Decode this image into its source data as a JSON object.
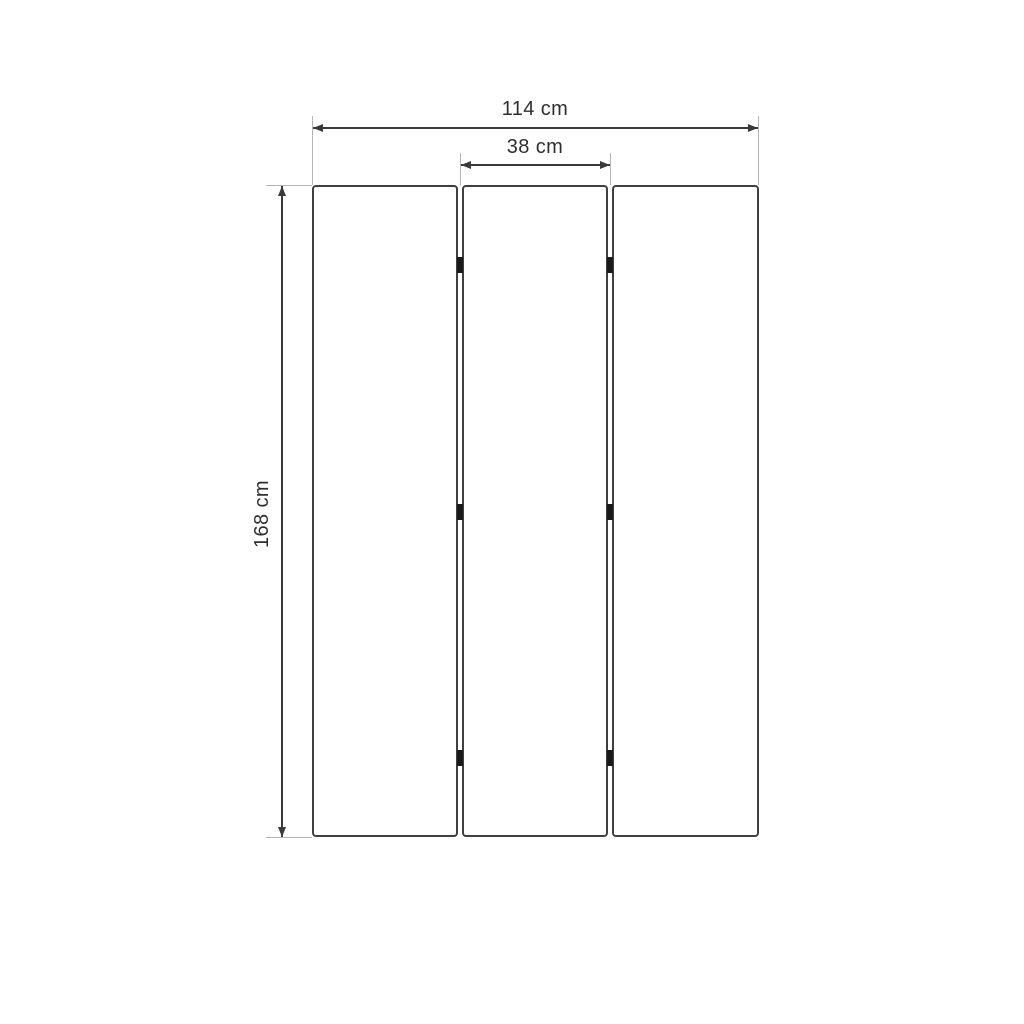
{
  "diagram": {
    "name": "three-panel-folding-screen-dimension-drawing",
    "type": "dimension-drawing",
    "panel_count": 3,
    "dimensions": {
      "total_width": {
        "label": "114 cm",
        "value": 114,
        "unit": "cm"
      },
      "panel_width": {
        "label": "38 cm",
        "value": 38,
        "unit": "cm"
      },
      "height": {
        "label": "168 cm",
        "value": 168,
        "unit": "cm"
      }
    },
    "colors": {
      "background": "#ffffff",
      "panel_border": "#404040",
      "dimension_line": "#3a3a3a",
      "extension_line": "#b5b5b5",
      "text": "#2f2f2f",
      "hinge": "#1a1a1a"
    }
  }
}
